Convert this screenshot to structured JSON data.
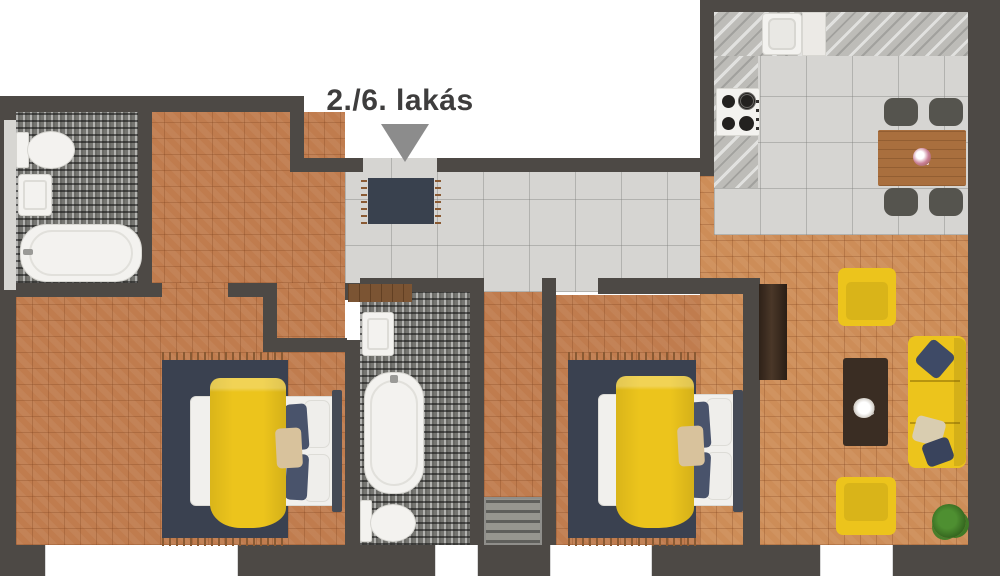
{
  "annotation": {
    "label": "2./6. lakás",
    "pointer": "down-triangle",
    "target": "entrance-door"
  },
  "palette": {
    "wall": "#4d4945",
    "floor_wood_bedroom": "#c07c4e",
    "floor_wood_living": "#cd8d58",
    "floor_tile": "#d6d5d2",
    "floor_mosaic": "#757571",
    "floor_closet": "#8f8e8a",
    "counter_marble": "#bdbcb8",
    "accent_yellow": "#ecc41c",
    "rug_navy": "#3a4150",
    "doormat_navy": "#39414e",
    "pillow_navy": "#49536b",
    "pillow_beige": "#d8c29c",
    "mattress_white": "#f1f0ed",
    "fixture_white": "#f3f2ef",
    "table_wood": "#a96f3e",
    "coffee_table_brown": "#3a2d23",
    "wardrobe_brown": "#4a3728",
    "hall_wardrobe_brown": "#7b5433",
    "chair_gray": "#55544e",
    "plant_green": "#4e8f31",
    "headboard_dark": "#454a55",
    "fringe_brown": "#8a5a33",
    "arrow_gray": "#8c8c8c",
    "text_color": "#3e3d3d"
  },
  "rooms": [
    {
      "id": "bathroom-1",
      "floor": "mosaic-tile",
      "fixtures": [
        "toilet",
        "sink",
        "bathtub"
      ]
    },
    {
      "id": "entry-hall",
      "floor": "large-tile",
      "fixtures": [
        "doormat",
        "low-wardrobe"
      ]
    },
    {
      "id": "bedroom-1",
      "floor": "herringbone-wood",
      "fixtures": [
        "double-bed",
        "yellow-duvet",
        "navy-rug",
        "pillows"
      ]
    },
    {
      "id": "bathroom-2",
      "floor": "mosaic-tile",
      "fixtures": [
        "sink",
        "bathtub",
        "toilet"
      ]
    },
    {
      "id": "corridor-closet",
      "floor": "wood-and-tile",
      "fixtures": [
        "shelf-unit"
      ]
    },
    {
      "id": "bedroom-2",
      "floor": "herringbone-wood",
      "fixtures": [
        "double-bed",
        "yellow-duvet",
        "navy-rug",
        "pillows"
      ]
    },
    {
      "id": "kitchen-dining",
      "floor": "large-tile",
      "fixtures": [
        "l-shaped-counter",
        "kitchen-sink",
        "cooktop",
        "dining-table",
        "four-chairs",
        "table-flowers"
      ]
    },
    {
      "id": "living-room",
      "floor": "herringbone-wood",
      "fixtures": [
        "sofa",
        "armchair",
        "armchair",
        "coffee-table",
        "tall-wardrobe",
        "potted-plant",
        "throw-pillows"
      ]
    }
  ],
  "openings": {
    "entrance_top": 1,
    "windows_bottom": 4,
    "window_left": 1
  }
}
